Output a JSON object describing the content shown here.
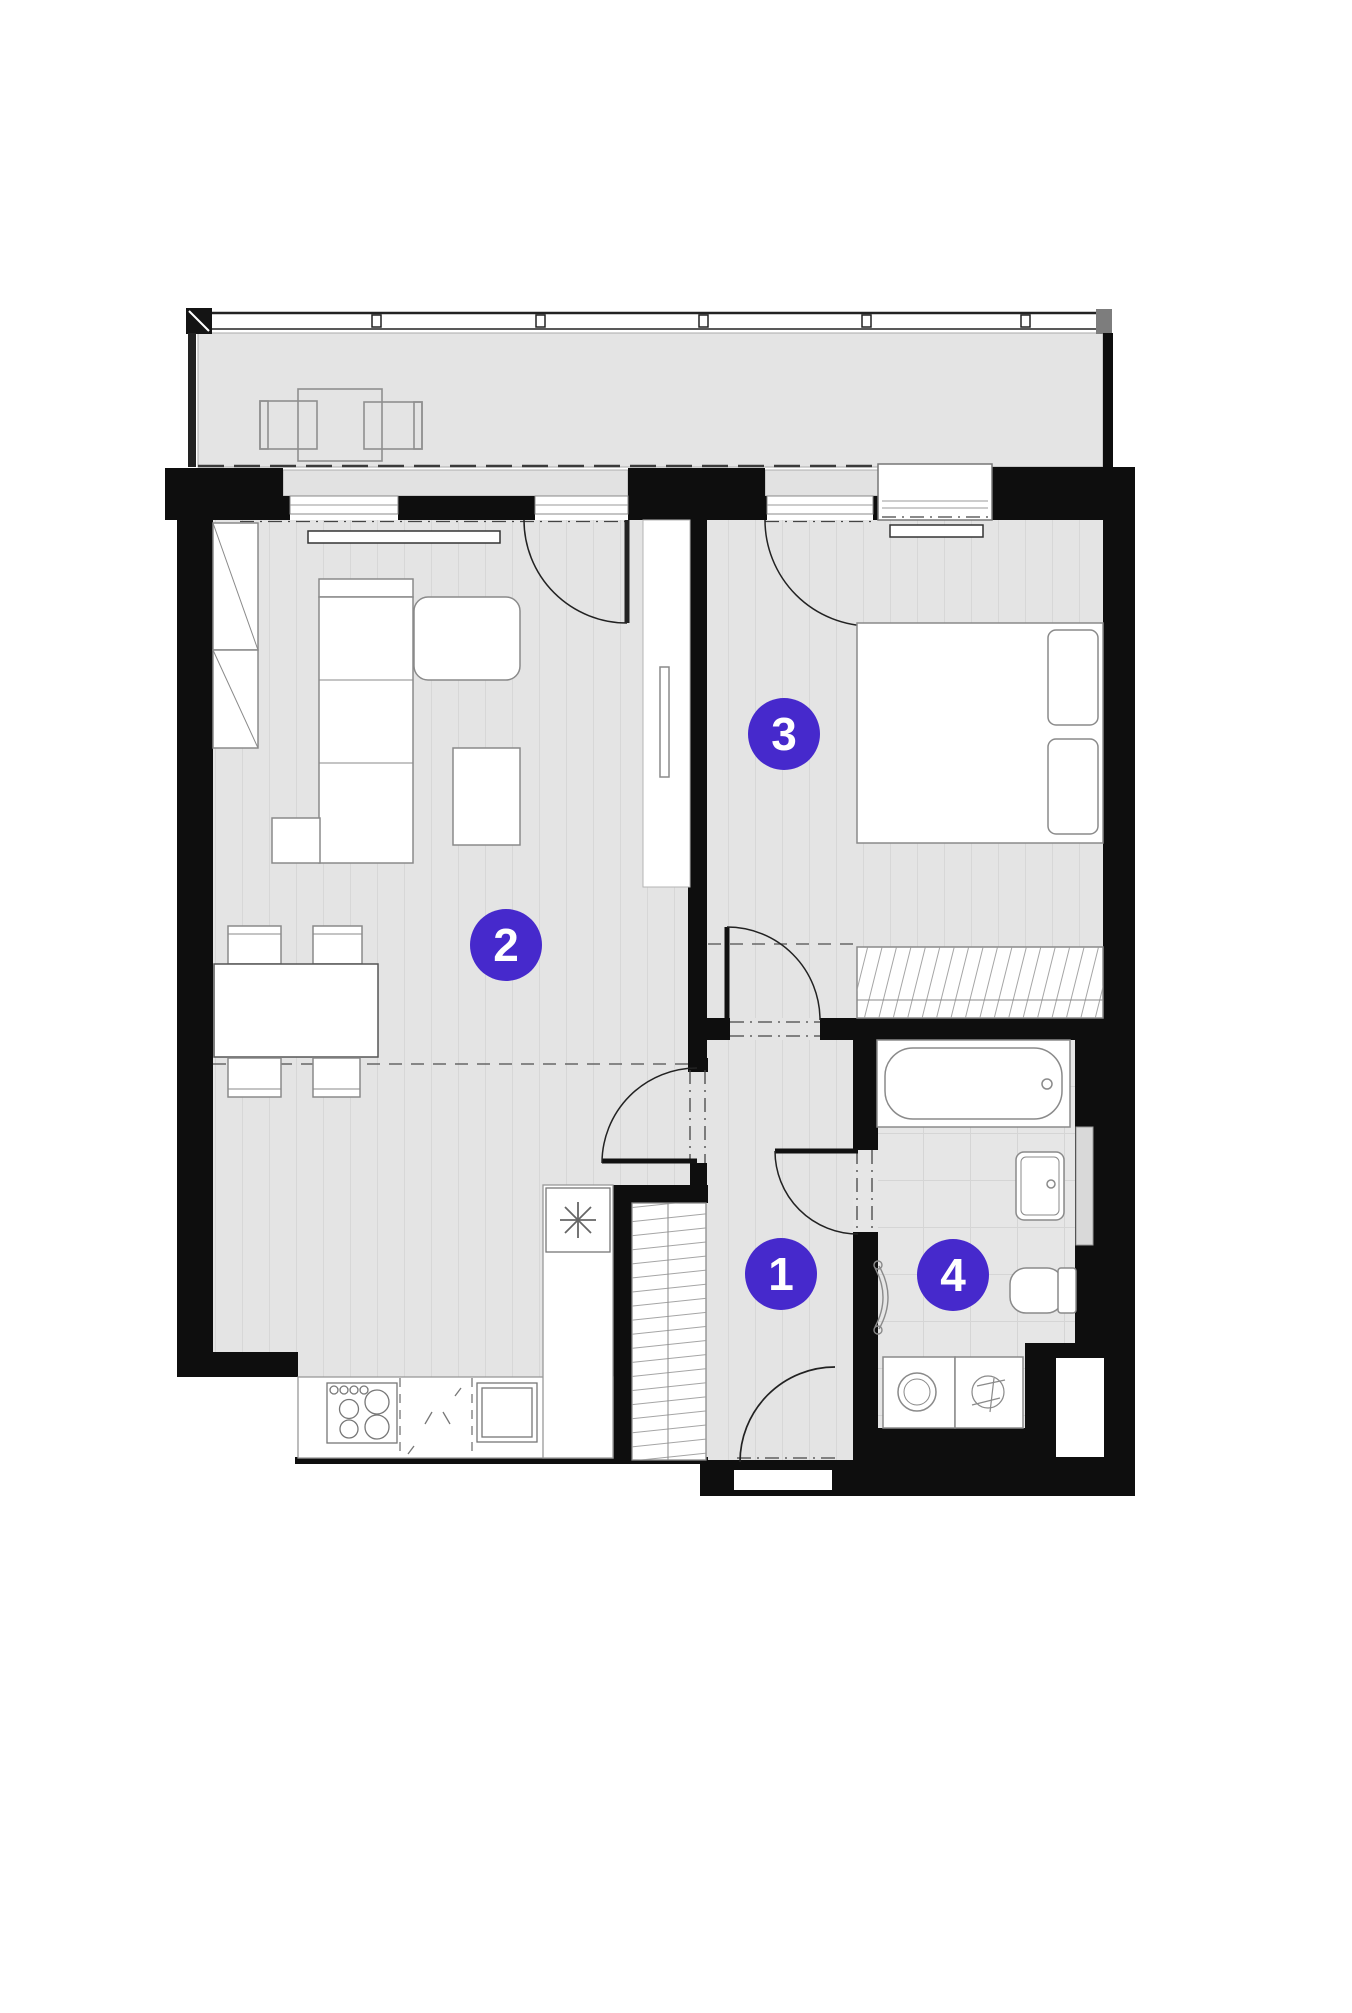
{
  "plan": {
    "title": "apartment-floor-plan",
    "accent_color": "#4629cc",
    "wall_color": "#0e0e0e",
    "floor_color": "#e4e4e4",
    "rooms": [
      {
        "id": 1,
        "label": "1"
      },
      {
        "id": 2,
        "label": "2"
      },
      {
        "id": 3,
        "label": "3"
      },
      {
        "id": 4,
        "label": "4"
      }
    ]
  }
}
